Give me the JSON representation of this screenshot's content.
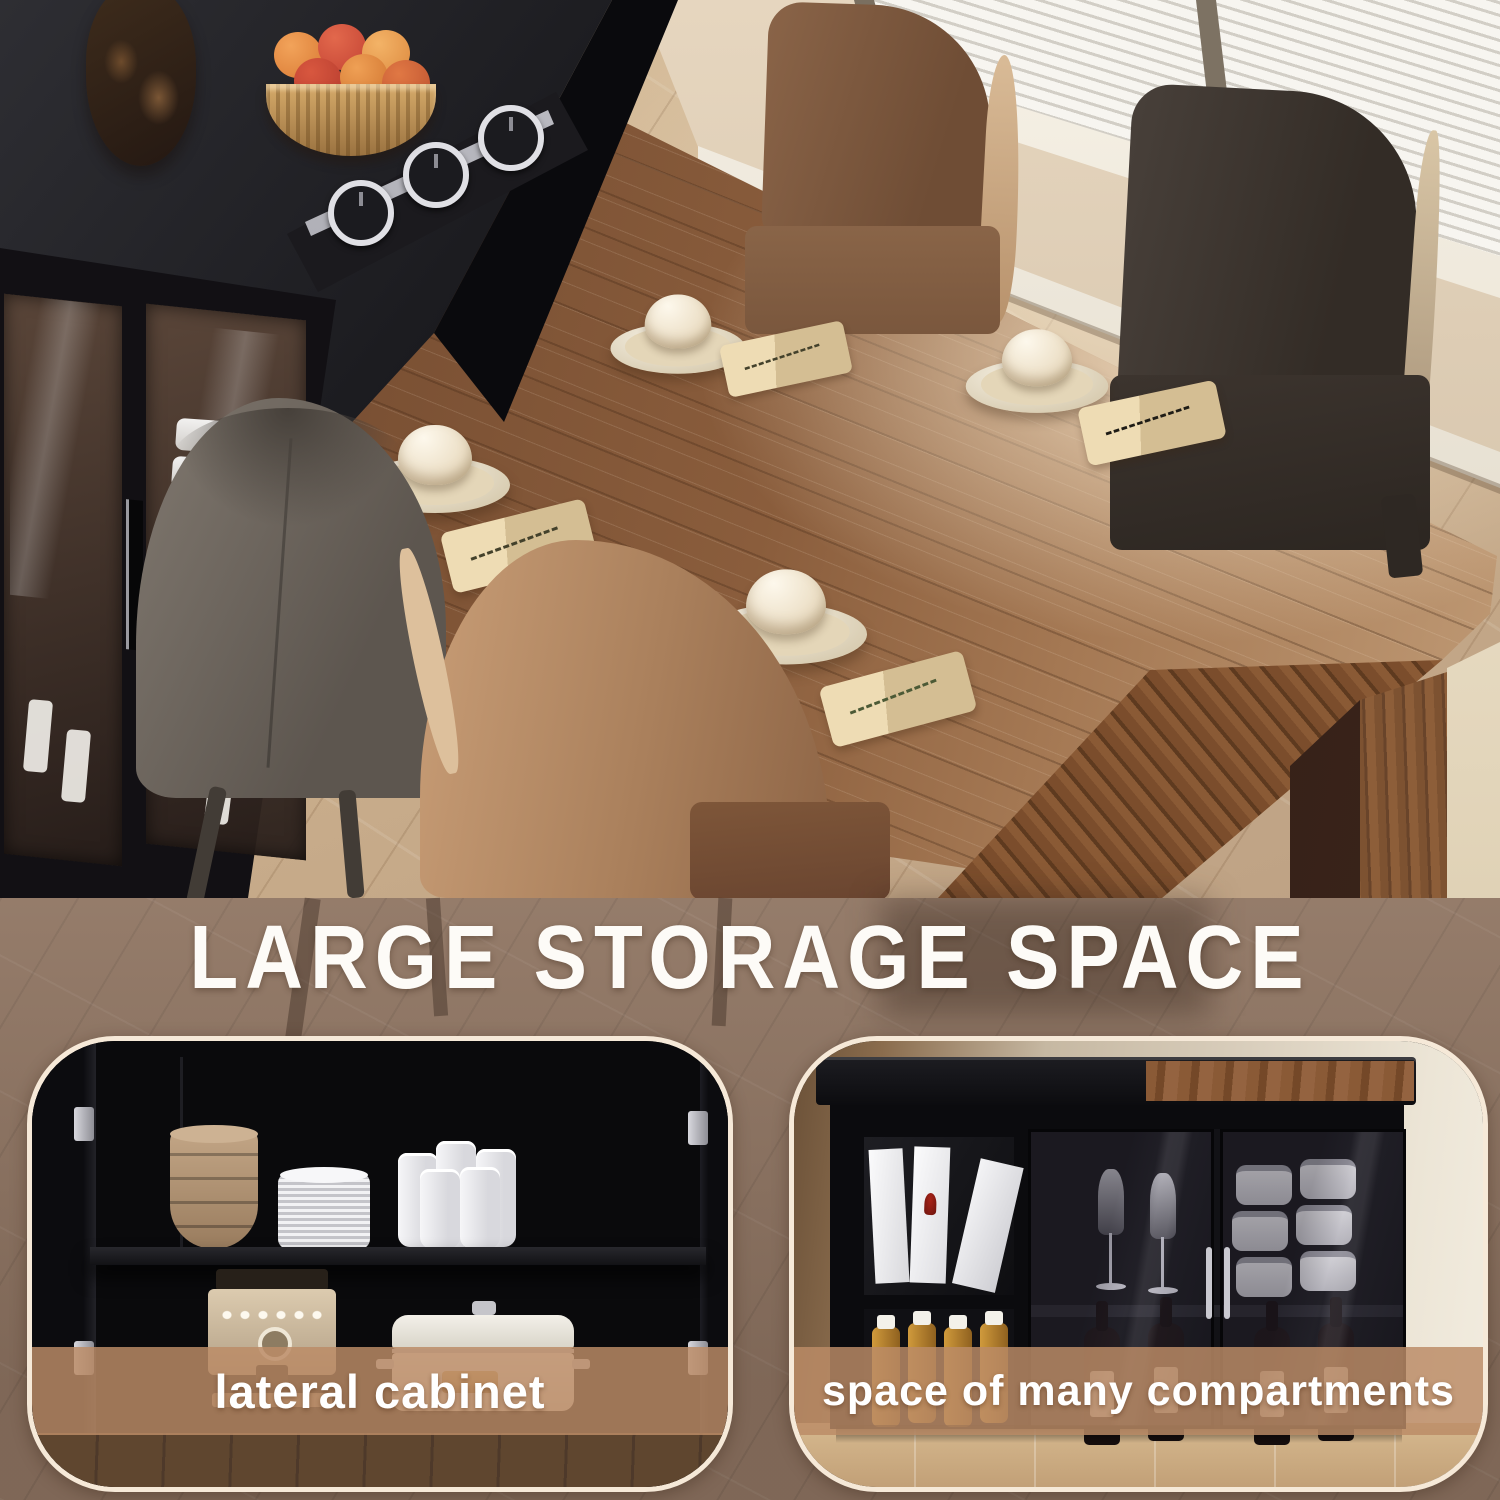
{
  "banner": {
    "title": "LARGE STORAGE SPACE"
  },
  "cards": [
    {
      "id": "lateral-cabinet",
      "caption": "lateral cabinet"
    },
    {
      "id": "compartments",
      "caption": "space of many compartments"
    }
  ],
  "colors": {
    "band_overlay": "#8d7361",
    "caption_bar": "rgba(187,140,103,0.84)",
    "card_border": "#f6e9d8",
    "heading_text": "#fdfbf7"
  }
}
